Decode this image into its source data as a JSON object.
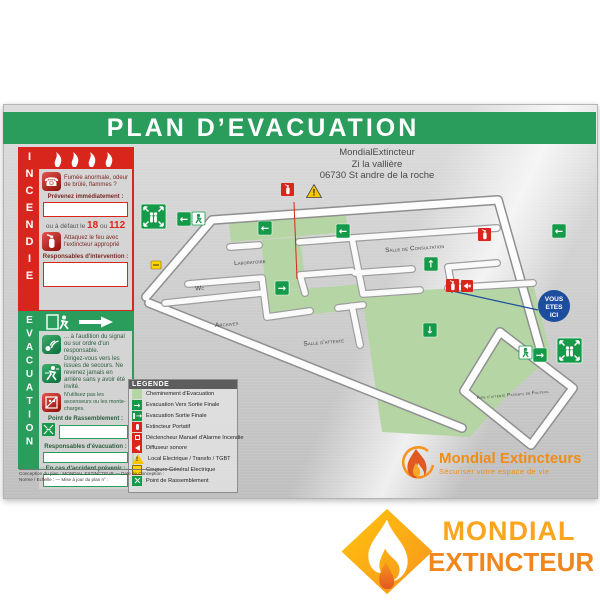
{
  "board": {
    "title": "PLAN D’EVACUATION",
    "address": {
      "line1": "MondialExtincteur",
      "line2": "Zi la vallière",
      "line3": "06730 St andre de la roche"
    },
    "incendie": {
      "vertical_letters": "INCENDIE",
      "smoke_text": "Fumée anormale, odeur de brûlé, flammes ?",
      "notify_label": "Prévenez immédiatement :",
      "fallback_prefix": "ou à défaut le",
      "number_fire": "18",
      "fallback_or": "ou",
      "number_emergency": "112",
      "attack_text": "Attaquez le feu avec l'extincteur approprié",
      "responsables_label": "Responsables d'intervention :"
    },
    "evacuation": {
      "vertical_letters": "EVACUATION",
      "signal_text": "... à l'audition du signal ou sur ordre d'un responsable.",
      "exits_text": "Dirigez-vous vers les issues de secours. Ne revenez jamais en arrière sans y avoir été invité.",
      "lift_text": "N'utilisez pas les ascenseurs ou les monte-charges.",
      "assembly_label": "Point de Rassemblement :",
      "responsables_label": "Responsables d'évacuation :",
      "accident_label": "En cas d'accident prévenir :"
    },
    "legend": {
      "title": "LEGENDE",
      "items": [
        {
          "icon": "evacuation-path",
          "label": "Cheminement d'Evacuation"
        },
        {
          "icon": "exit-arrow",
          "label": "Evacuation Vers Sortie Finale"
        },
        {
          "icon": "exit-final",
          "label": "Evacuation Sortie Finale"
        },
        {
          "icon": "extinguisher",
          "label": "Extincteur Portatif"
        },
        {
          "icon": "manual-alarm",
          "label": "Déclencheur Manuel d'Alarme Incendie"
        },
        {
          "icon": "sounder",
          "label": "Diffuseur sonore"
        },
        {
          "icon": "electrical-warning",
          "label": "Local Electrique / Transfo / TGBT"
        },
        {
          "icon": "power-cutoff",
          "label": "Coupure Général Electrique"
        },
        {
          "icon": "assembly-point",
          "label": "Point de Rassemblement"
        }
      ]
    },
    "map": {
      "rooms": {
        "laboratoire": "Laboratoire",
        "wc": "Wc",
        "archives": "Archives",
        "consultation": "Salle de Consultation",
        "attente": "Salle d'attente",
        "fauteuil": "Aire d'attente Patients en Fauteuil"
      },
      "you_are_here": {
        "l1": "VOUS",
        "l2": "ETES",
        "l3": "ICI"
      }
    },
    "fineprint": {
      "line1": "Conception du plan : MONDIAL EXTINCTEUR — Date de Conception :",
      "line2": "Norme / Echelle : — Mise à jour du plan n° :"
    },
    "brand": {
      "name": "Mondial Extincteurs",
      "tagline": "Sécuriser votre espace de vie"
    }
  },
  "footer_logo": {
    "word1": "MONDIAL",
    "word2": "EXTINCTEUR"
  },
  "colors": {
    "banner_green": "#2a9d5c",
    "fire_red": "#d9261c",
    "exit_green": "#149a49",
    "path_green": "#b5d6a4",
    "warning_yellow": "#f7c600",
    "brand_orange": "#f7941d",
    "here_blue": "#1d4e9e"
  }
}
